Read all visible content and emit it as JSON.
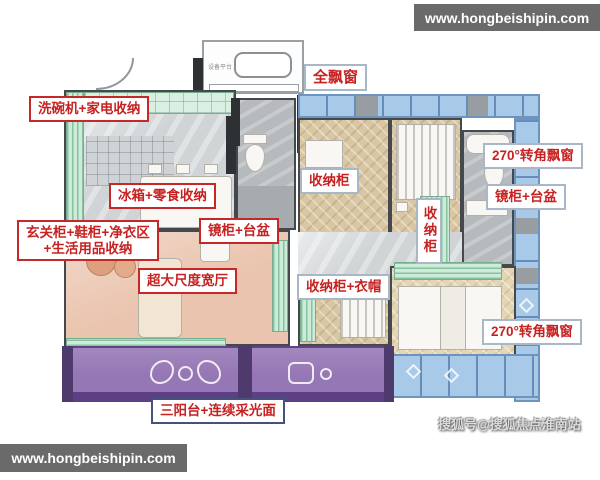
{
  "watermarks": {
    "top_right": "www.hongbeishipin.com",
    "bottom_left": "www.hongbeishipin.com",
    "sohu_credit": "搜狐号@搜狐焦点淮南站"
  },
  "annotations": {
    "dishwasher_appliance_storage": "洗碗机+家电收纳",
    "full_bay_window": "全飘窗",
    "fridge_snack_storage": "冰箱+零食收纳",
    "entry_cabinet_line1": "玄关柜+鞋柜+净衣区",
    "entry_cabinet_line2": "+生活用品收纳",
    "mirror_cabinet_basin_left": "镜柜+台盆",
    "storage_cabinet_small": "收纳柜",
    "extra_wide_living_hall": "超大尺度宽厅",
    "storage_cabinet_wardrobe": "收纳柜+衣帽",
    "storage_cabinet_vertical": "收纳柜",
    "corner_bay_window_top": "270°转角飘窗",
    "mirror_cabinet_basin_right": "镜柜+台盆",
    "corner_bay_window_bottom": "270°转角飘窗",
    "triple_balcony_daylight": "三阳台+连续采光面"
  },
  "plan_text": {
    "equipment_platform": "设备平台"
  },
  "colors": {
    "annotation_red": "#c62222",
    "balcony_purple": "#9677b5",
    "bay_window_blue": "#a9c9e8",
    "living_room_pink": "#eac4ae",
    "kitchen_mint": "#cdebd9",
    "bedroom_wood_tan": "#d9c6a2",
    "watermark_gray": "#6a6a6a"
  }
}
